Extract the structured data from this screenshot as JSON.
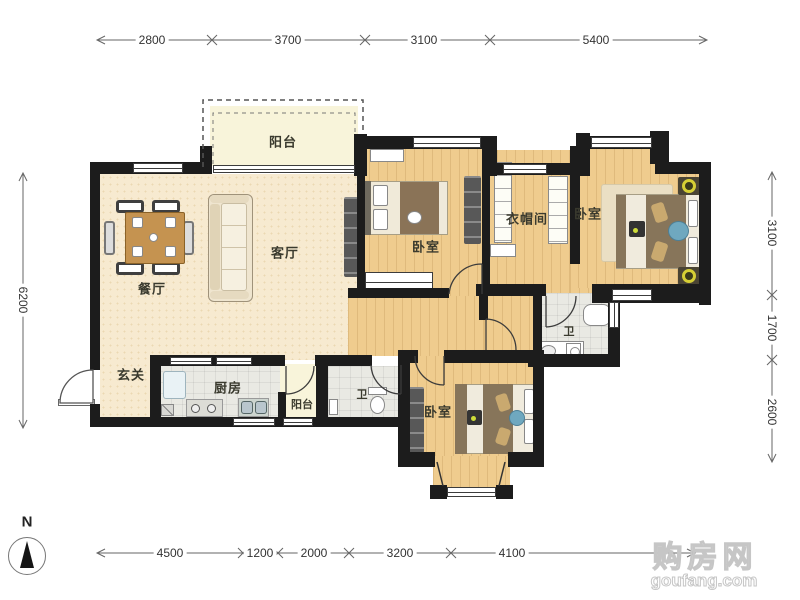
{
  "floorplan": {
    "rooms": {
      "balcony_top": {
        "label": "阳台"
      },
      "living": {
        "label": "客厅"
      },
      "dining": {
        "label": "餐厅"
      },
      "entry": {
        "label": "玄关"
      },
      "kitchen": {
        "label": "厨房"
      },
      "balcony_bottom": {
        "label": "阳台"
      },
      "bathroom_main": {
        "label": "卫"
      },
      "bathroom_second": {
        "label": "卫"
      },
      "cloakroom": {
        "label": "衣帽间"
      },
      "bedroom_middle": {
        "label": "卧室"
      },
      "bedroom_right": {
        "label": "卧室"
      },
      "bedroom_bottom": {
        "label": "卧室"
      }
    },
    "dimensions": {
      "top": [
        "2800",
        "3700",
        "3100",
        "5400"
      ],
      "bottom": [
        "4500",
        "1200",
        "2000",
        "3200",
        "4100"
      ],
      "left": [
        "6200"
      ],
      "right": [
        "3100",
        "1700",
        "2600"
      ]
    },
    "compass": {
      "label": "N"
    }
  },
  "watermark": {
    "site_name": "购房网",
    "site_domain": "goufang.com"
  },
  "colors": {
    "wall": "#1c1c1c",
    "wood_floor": "#efcc8e",
    "living_floor": "#f7ead0",
    "tile_floor": "#e9e9e3",
    "balcony_floor": "#f8f4da",
    "dimension_text": "#333333"
  }
}
